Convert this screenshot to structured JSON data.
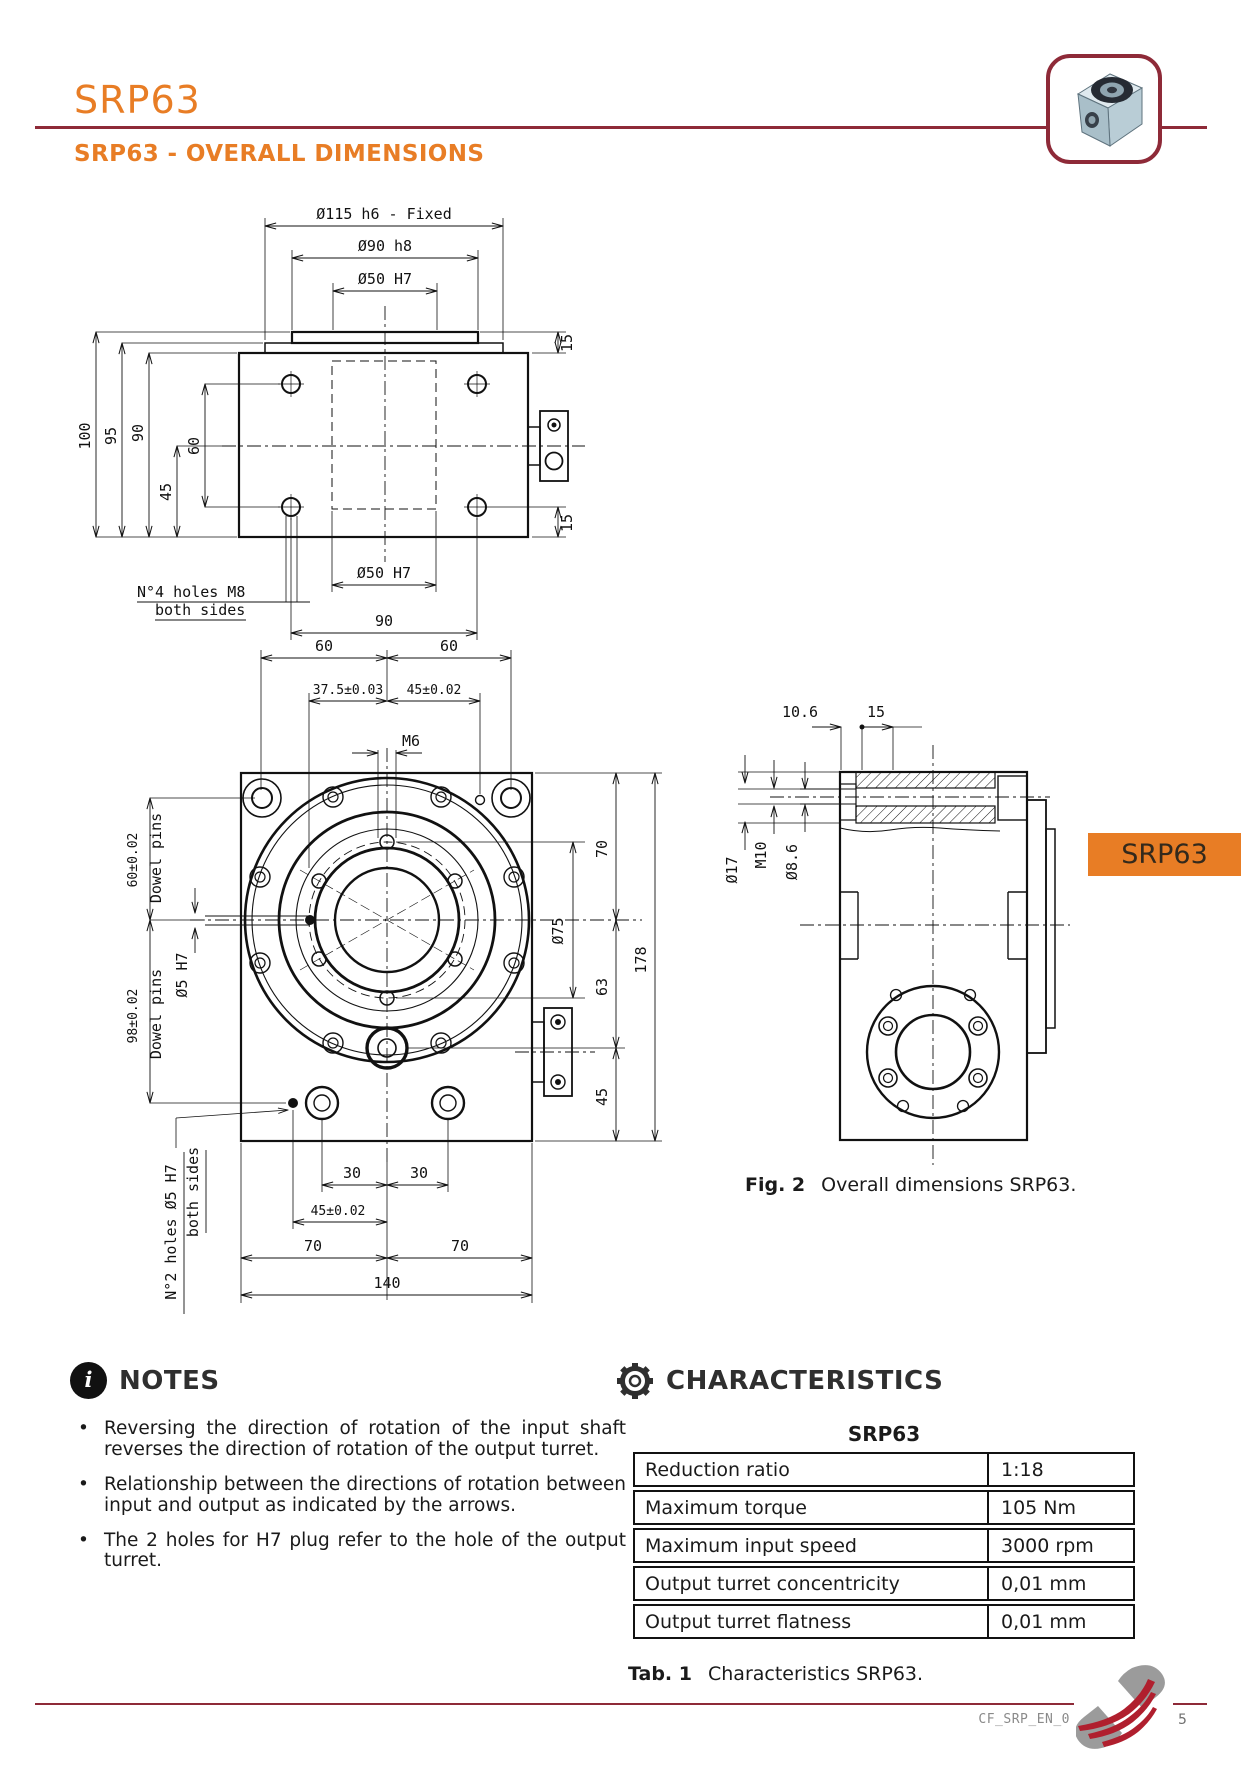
{
  "header": {
    "title": "SRP63"
  },
  "section_title": "SRP63 - OVERALL DIMENSIONS",
  "side_tab": "SRP63",
  "fig2": {
    "label": "Fig. 2",
    "text": "Overall dimensions SRP63."
  },
  "notes": {
    "heading": "NOTES",
    "items": [
      "Reversing the direction of rotation of the input shaft reverses the direction of rotation of the output turret.",
      "Relationship between the directions of rotation between input and output as indicated by the arrows.",
      "The 2 holes for H7 plug refer to the hole of the output turret."
    ]
  },
  "characteristics": {
    "heading": "CHARACTERISTICS",
    "table_title": "SRP63",
    "rows": [
      {
        "label": "Reduction ratio",
        "value": "1:18"
      },
      {
        "label": "Maximum torque",
        "value": "105 Nm"
      },
      {
        "label": "Maximum input speed",
        "value": "3000 rpm"
      },
      {
        "label": "Output turret concentricity",
        "value": "0,01 mm"
      },
      {
        "label": "Output turret flatness",
        "value": "0,01 mm"
      }
    ],
    "caption": {
      "label": "Tab. 1",
      "text": "Characteristics SRP63."
    }
  },
  "footer": {
    "doc_code": "CF_SRP_EN_0",
    "page_number": "5"
  },
  "colors": {
    "accent_orange": "#e87d25",
    "brand_maroon": "#8e2a38"
  },
  "drawings": {
    "top_view": {
      "d115": "Ø115 h6 - Fixed",
      "d90": "Ø90 h8",
      "d50_top": "Ø50 H7",
      "v100": "100",
      "v95": "95",
      "v90": "90",
      "v60": "60",
      "v45": "45",
      "r15_top": "15",
      "r15_bot": "15",
      "d50_bot": "Ø50 H7",
      "h90": "90",
      "holes_note_1": "N°4 holes M8",
      "holes_note_2": "both sides"
    },
    "front_view": {
      "t60a": "60",
      "t60b": "60",
      "t375": "37.5±0.03",
      "t45": "45±0.02",
      "m6": "M6",
      "l60": "60±0.02",
      "l60_lbl": "Dowel pins",
      "l5h7": "Ø5 H7",
      "l98": "98±0.02",
      "l98_lbl": "Dowel pins",
      "r70": "70",
      "r75": "Ø75",
      "r63": "63",
      "r178": "178",
      "r45": "45",
      "b30a": "30",
      "b30b": "30",
      "b45": "45±0.02",
      "b70a": "70",
      "b70b": "70",
      "b140": "140",
      "holes_note_1": "N°2 holes Ø5 H7",
      "holes_note_2": "both sides"
    },
    "side_view": {
      "t106": "10.6",
      "t15": "15",
      "d17": "Ø17",
      "m10": "M10",
      "d86": "Ø8.6"
    }
  }
}
